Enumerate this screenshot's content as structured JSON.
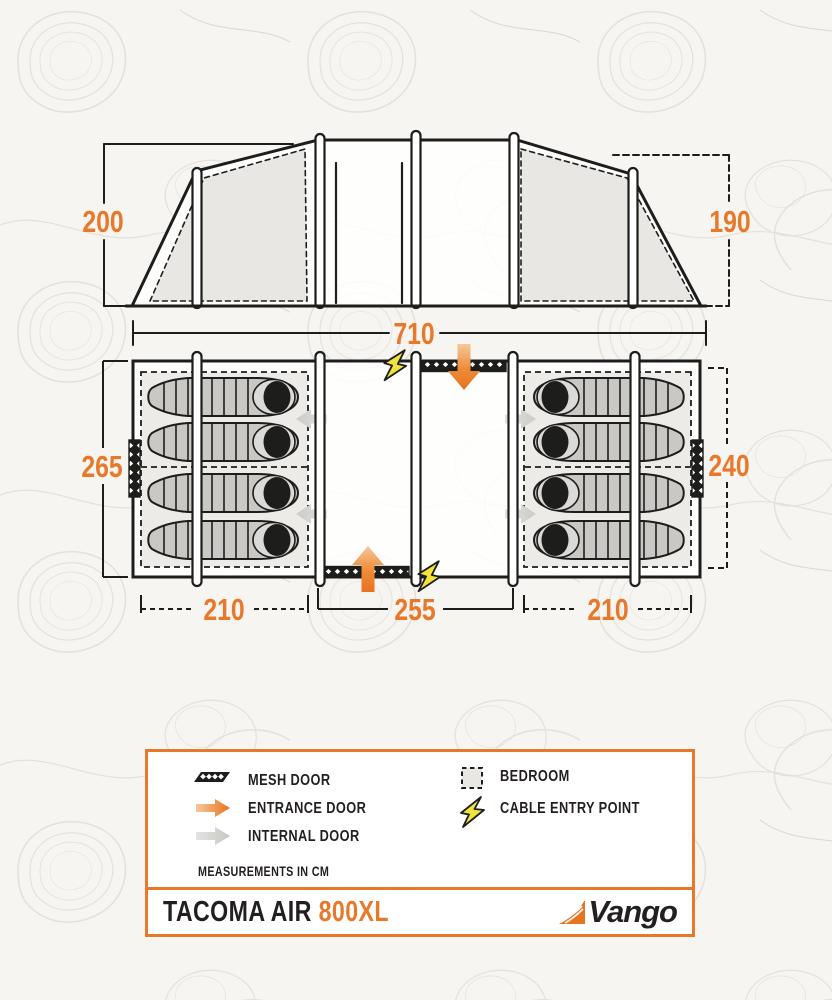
{
  "diagram": {
    "title": "Tent floorplan diagram",
    "dimensions": {
      "total_width": "710",
      "height_left": "200",
      "height_right": "190",
      "depth_left": "265",
      "depth_right": "240",
      "bedroom_left_width": "210",
      "living_width": "255",
      "bedroom_right_width": "210"
    }
  },
  "legend": {
    "items": [
      {
        "id": "mesh-door",
        "label": "MESH DOOR"
      },
      {
        "id": "entrance-door",
        "label": "ENTRANCE DOOR"
      },
      {
        "id": "internal-door",
        "label": "INTERNAL DOOR"
      },
      {
        "id": "bedroom",
        "label": "BEDROOM"
      },
      {
        "id": "cable-entry-point",
        "label": "CABLE ENTRY POINT"
      }
    ],
    "note": "MEASUREMENTS IN CM"
  },
  "footer": {
    "product_name": "TACOMA AIR",
    "product_model": "800XL",
    "brand": "Vango"
  },
  "colors": {
    "accent_orange": "#E8782A",
    "line_black": "#1D1D1B",
    "bolt_yellow": "#F2E33C",
    "panel_gray": "#E9E7E3",
    "bag_gray": "#C9C8C5",
    "arrow_gray": "#D7D6D3"
  }
}
